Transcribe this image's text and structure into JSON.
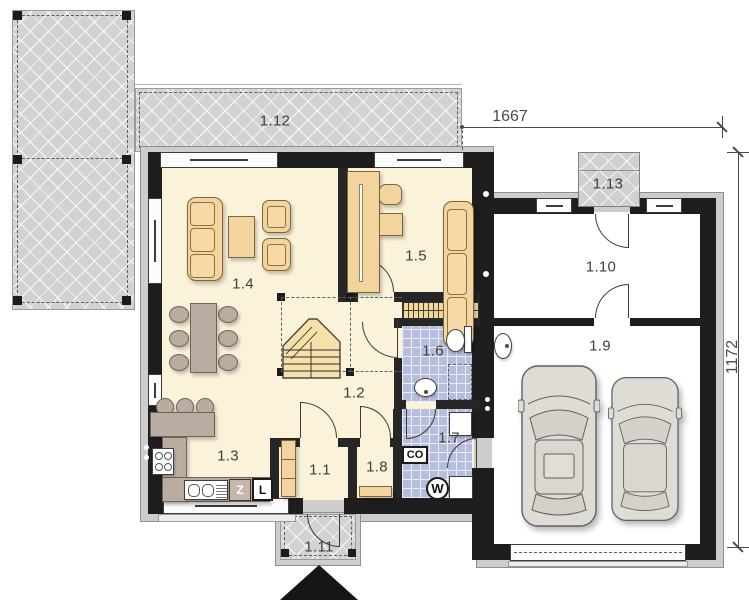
{
  "rooms": {
    "r1_1": "1.1",
    "r1_2": "1.2",
    "r1_3": "1.3",
    "r1_4": "1.4",
    "r1_5": "1.5",
    "r1_6": "1.6",
    "r1_7": "1.7",
    "r1_8": "1.8",
    "r1_9": "1.9",
    "r1_10": "1.10",
    "r1_11": "1.11",
    "r1_12": "1.12",
    "r1_13": "1.13"
  },
  "dimensions": {
    "top_width": "1667",
    "right_height": "1172"
  },
  "appliances": {
    "dishwasher": "Z",
    "fridge": "L",
    "heating_unit": "CO",
    "water_heater": "W"
  },
  "colors": {
    "wall": "#1e1e1e",
    "floor": "#faf3da",
    "furniture_wood": "#f3d49e",
    "furniture_taupe": "#b9aca0",
    "bathroom_tiles": "#b7bddc",
    "terrace": "#d2d2d2"
  }
}
